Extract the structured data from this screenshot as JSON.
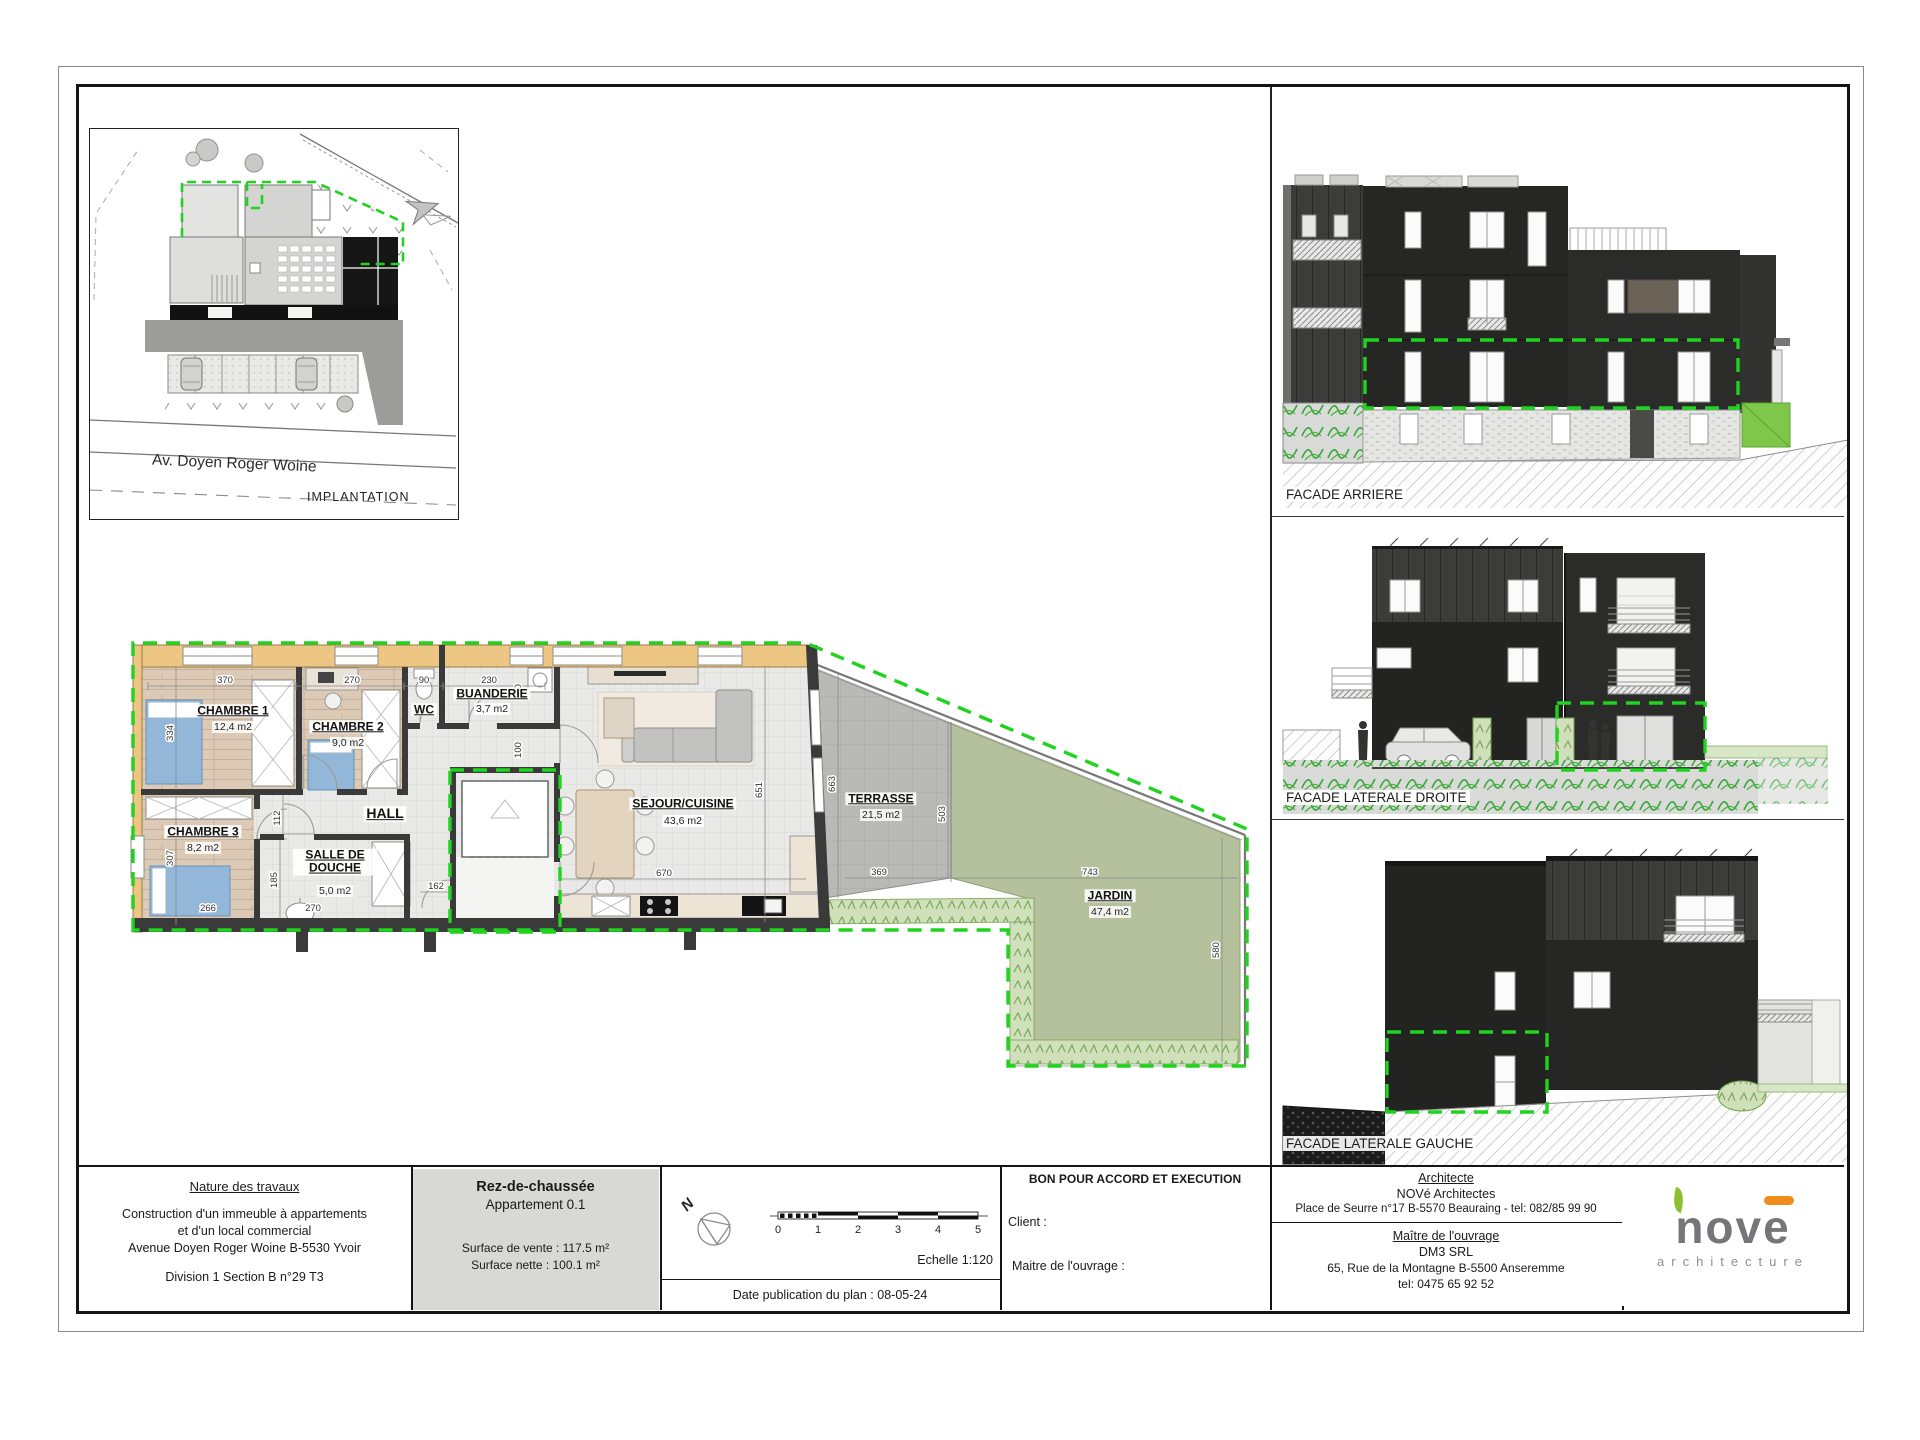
{
  "implantation": {
    "street": "Av. Doyen Roger Woine",
    "caption": "IMPLANTATION"
  },
  "plan": {
    "rooms": {
      "chambre1": {
        "name": "CHAMBRE 1",
        "area": "12,4 m2"
      },
      "chambre2": {
        "name": "CHAMBRE 2",
        "area": "9,0 m2"
      },
      "chambre3": {
        "name": "CHAMBRE 3",
        "area": "8,2 m2"
      },
      "wc": {
        "name": "WC"
      },
      "buanderie": {
        "name": "BUANDERIE",
        "area": "3,7 m2"
      },
      "hall": {
        "name": "HALL"
      },
      "salle_de_douche": {
        "name": "SALLE DE DOUCHE",
        "area": "5,0 m2"
      },
      "sejour": {
        "name": "SEJOUR/CUISINE",
        "area": "43,6 m2"
      },
      "terrasse": {
        "name": "TERRASSE",
        "area": "21,5 m2"
      },
      "jardin": {
        "name": "JARDIN",
        "area": "47,4 m2"
      }
    },
    "dims": [
      {
        "v": "370"
      },
      {
        "v": "270"
      },
      {
        "v": "90"
      },
      {
        "v": "230"
      },
      {
        "v": "334"
      },
      {
        "v": "160"
      },
      {
        "v": "100"
      },
      {
        "v": "307"
      },
      {
        "v": "266"
      },
      {
        "v": "112"
      },
      {
        "v": "185"
      },
      {
        "v": "270"
      },
      {
        "v": "162"
      },
      {
        "v": "651"
      },
      {
        "v": "670"
      },
      {
        "v": "663"
      },
      {
        "v": "503"
      },
      {
        "v": "369"
      },
      {
        "v": "743"
      },
      {
        "v": "580"
      }
    ]
  },
  "facades": {
    "arriere": "FACADE ARRIERE",
    "droite": "FACADE LATERALE DROITE",
    "gauche": "FACADE LATERALE GAUCHE"
  },
  "titleblock": {
    "nature_title": "Nature des travaux",
    "nature_line1": "Construction d'un immeuble à appartements",
    "nature_line2": "et d'un local commercial",
    "nature_line3": "Avenue Doyen Roger Woine B-5530 Yvoir",
    "nature_line4": "Division 1 Section B n°29 T3",
    "level_title": "Rez-de-chaussée",
    "level_sub": "Appartement 0.1",
    "surface_vente": "Surface de vente : 117.5 m²",
    "surface_nette": "Surface nette : 100.1 m²",
    "echelle": "Echelle 1:120",
    "date_line": "Date publication du plan : 08-05-24",
    "approval": "BON POUR ACCORD ET EXECUTION",
    "client_label": "Client :",
    "maitre_label": "Maitre de l'ouvrage :",
    "architect_title": "Architecte",
    "architect_name": "NOVé Architectes",
    "architect_address": "Place de Seurre n°17 B-5570 Beauraing - tel: 082/85 99 90",
    "owner_title": "Maître de l'ouvrage",
    "owner_name": "DM3 SRL",
    "owner_address": "65, Rue de la Montagne B-5500 Anseremme",
    "owner_tel": "tel: 0475 65 92 52",
    "north_letter": "N"
  },
  "scalebar": {
    "ticks": [
      "0",
      "1",
      "2",
      "3",
      "4",
      "5"
    ]
  },
  "logo": {
    "word": "nové",
    "part1": "nov",
    "part2": "e",
    "sub": "architecture"
  },
  "colors": {
    "dash_green": "#1fd31f",
    "wood_wall": "#eec684",
    "facade_dark": "#262624",
    "bed_blue": "#93b7d8",
    "garden_green": "#b5c19d",
    "leaf_green": "#8bbf2e",
    "accent_orange": "#f08c1e",
    "logo_gray": "#75757a"
  }
}
